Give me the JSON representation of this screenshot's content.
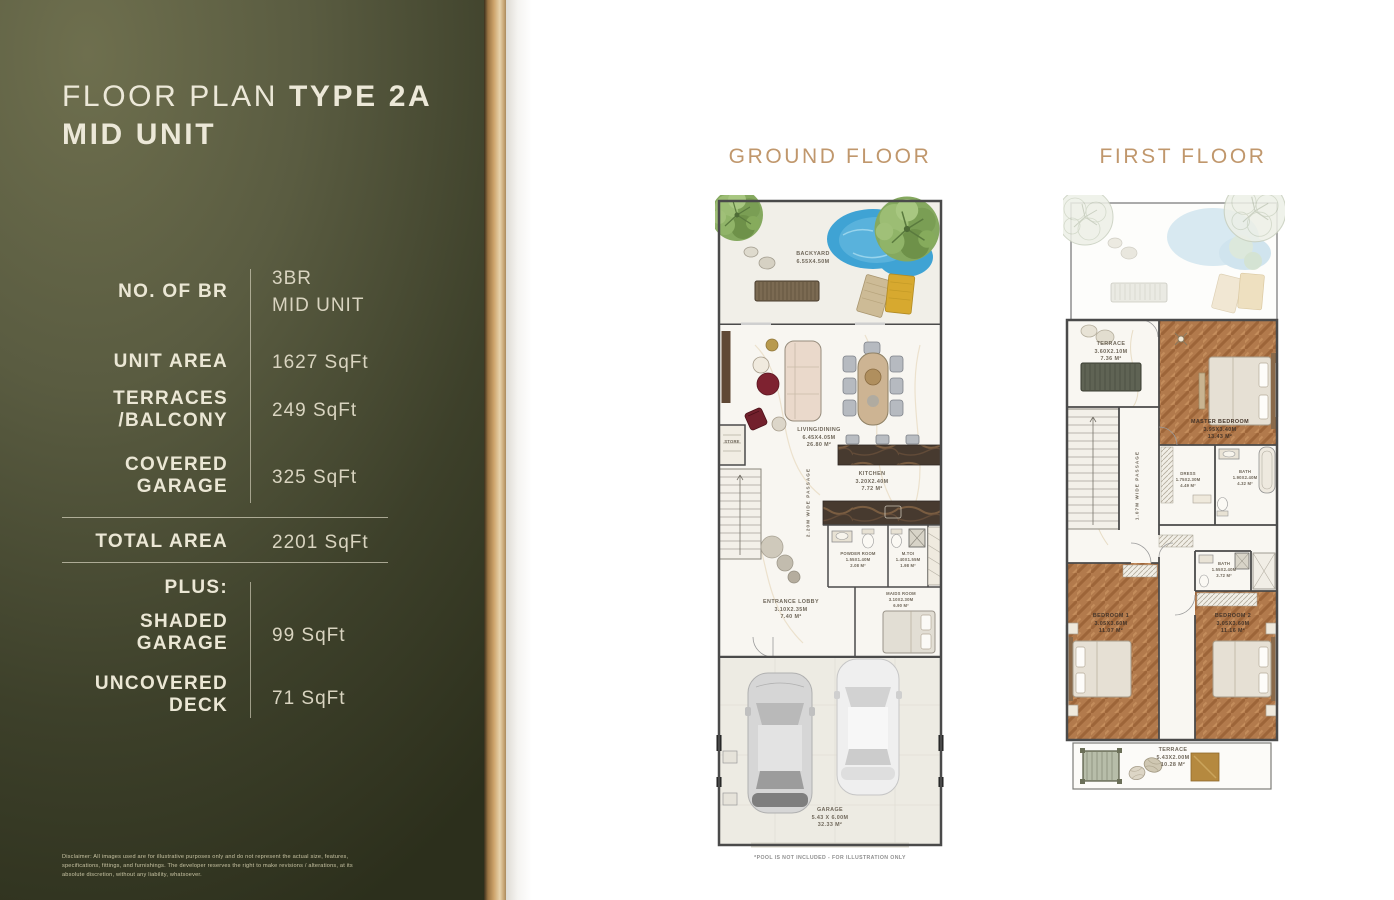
{
  "header": {
    "title_regular": "FLOOR PLAN",
    "title_bold": "TYPE 2A",
    "title_line2": "MID UNIT"
  },
  "specs": {
    "rows": [
      {
        "label": "NO. OF BR",
        "value": "3BR\nMID UNIT"
      },
      {
        "label": "UNIT AREA",
        "value": "1627 SqFt"
      },
      {
        "label": "TERRACES\n/BALCONY",
        "value": "249 SqFt"
      },
      {
        "label": "COVERED\nGARAGE",
        "value": "325 SqFt"
      }
    ],
    "total": {
      "label": "TOTAL AREA",
      "value": "2201 SqFt"
    },
    "plus_label": "PLUS:",
    "plus_rows": [
      {
        "label": "SHADED\nGARAGE",
        "value": "99 SqFt"
      },
      {
        "label": "UNCOVERED\nDECK",
        "value": "71 SqFt"
      }
    ]
  },
  "disclaimer": "Disclaimer: All images used are for illustrative purposes only and do not represent the actual size, features, specifications, fittings, and furnishings. The developer reserves the right to make revisions / alterations, at its absolute discretion, without any liability, whatsoever.",
  "ground_floor": {
    "title": "GROUND FLOOR",
    "labels": {
      "backyard": "BACKYARD\n6.55x4.50m",
      "living_dining": "LIVING/DINING\n6.45x4.05m\n26.80 m²",
      "kitchen": "KITCHEN\n3.20x2.40m\n7.72 m²",
      "store": "STORE",
      "passage": "2.20m WIDE PASSAGE",
      "entrance_lobby": "ENTRANCE LOBBY\n3.10x2.35m\n7.40 m²",
      "powder_room": "POWDER ROOM\n1.55x1.40m\n2.08 m²",
      "m_toi": "M.TOI\n1.40x1.55m\n1.98 m²",
      "maids_room": "MAIDS ROOM\n3.10x2.30m\n6.90 m²",
      "garage": "GARAGE\n5.43 x 6.00m\n32.33 m²"
    }
  },
  "first_floor": {
    "title": "FIRST FLOOR",
    "labels": {
      "terrace_top": "TERRACE\n3.60x2.10m\n7.36 m²",
      "master_bedroom": "MASTER BEDROOM\n3.95x3.40m\n13.43 m²",
      "dress": "DRESS\n1.75x2.30m\n4.49 m²",
      "bath_master": "BATH\n1.90x2.40m\n4.32 m²",
      "passage": "1.07m WIDE PASSAGE",
      "bath": "BATH\n1.55x2.40m\n3.72 m²",
      "bedroom_1": "BEDROOM 1\n3.05x3.60m\n11.07 m²",
      "bedroom_2": "BEDROOM 2\n3.05x3.60m\n11.16 m²",
      "terrace_bottom": "TERRACE\n5.43x2.00m\n10.28 m²"
    }
  },
  "footnote": "*POOL IS NOT INCLUDED - FOR ILLUSTRATION ONLY",
  "colors": {
    "panel_olive": "#565840",
    "stripe_gold": "#cda36b",
    "accent_gold": "#c0976c",
    "cream_text": "#ece8d8",
    "pool_blue": "#3fa3d4"
  }
}
